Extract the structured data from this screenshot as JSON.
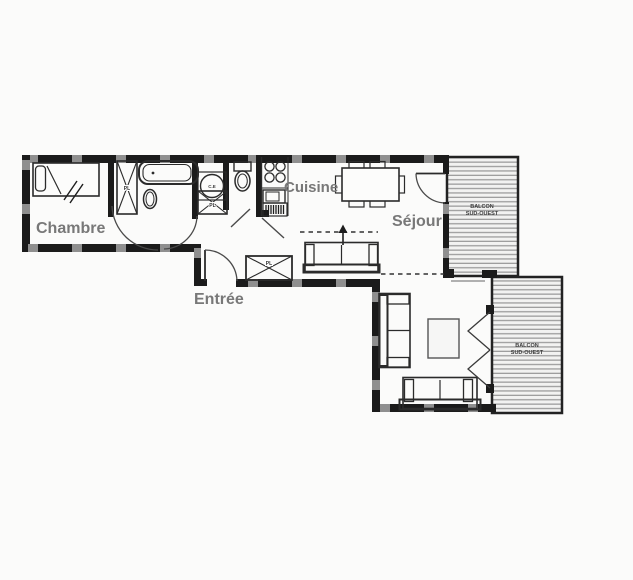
{
  "plan": {
    "type": "apartment-floor-plan",
    "rooms": {
      "chambre": {
        "label": "Chambre"
      },
      "cuisine": {
        "label": "Cuisine"
      },
      "sejour": {
        "label": "Séjour"
      },
      "entree": {
        "label": "Entrée"
      }
    },
    "balconies": {
      "balcon_haut": {
        "line1": "BALCON",
        "line2": "SUD-OUEST"
      },
      "balcon_bas": {
        "line1": "BALCON",
        "line2": "SUD-OUEST"
      }
    },
    "annotations": {
      "placard": "PL",
      "chauffe_eau": "C.E"
    },
    "colors": {
      "background": "#fbfbfa",
      "wall": "#1b1b1b",
      "wall_window_gap": "#8f8f8f",
      "line": "#2b2b2b",
      "room_label": "#787878",
      "balcony_stripe": "#9d9d9d",
      "balcony_fill": "#f2f2f1"
    }
  }
}
